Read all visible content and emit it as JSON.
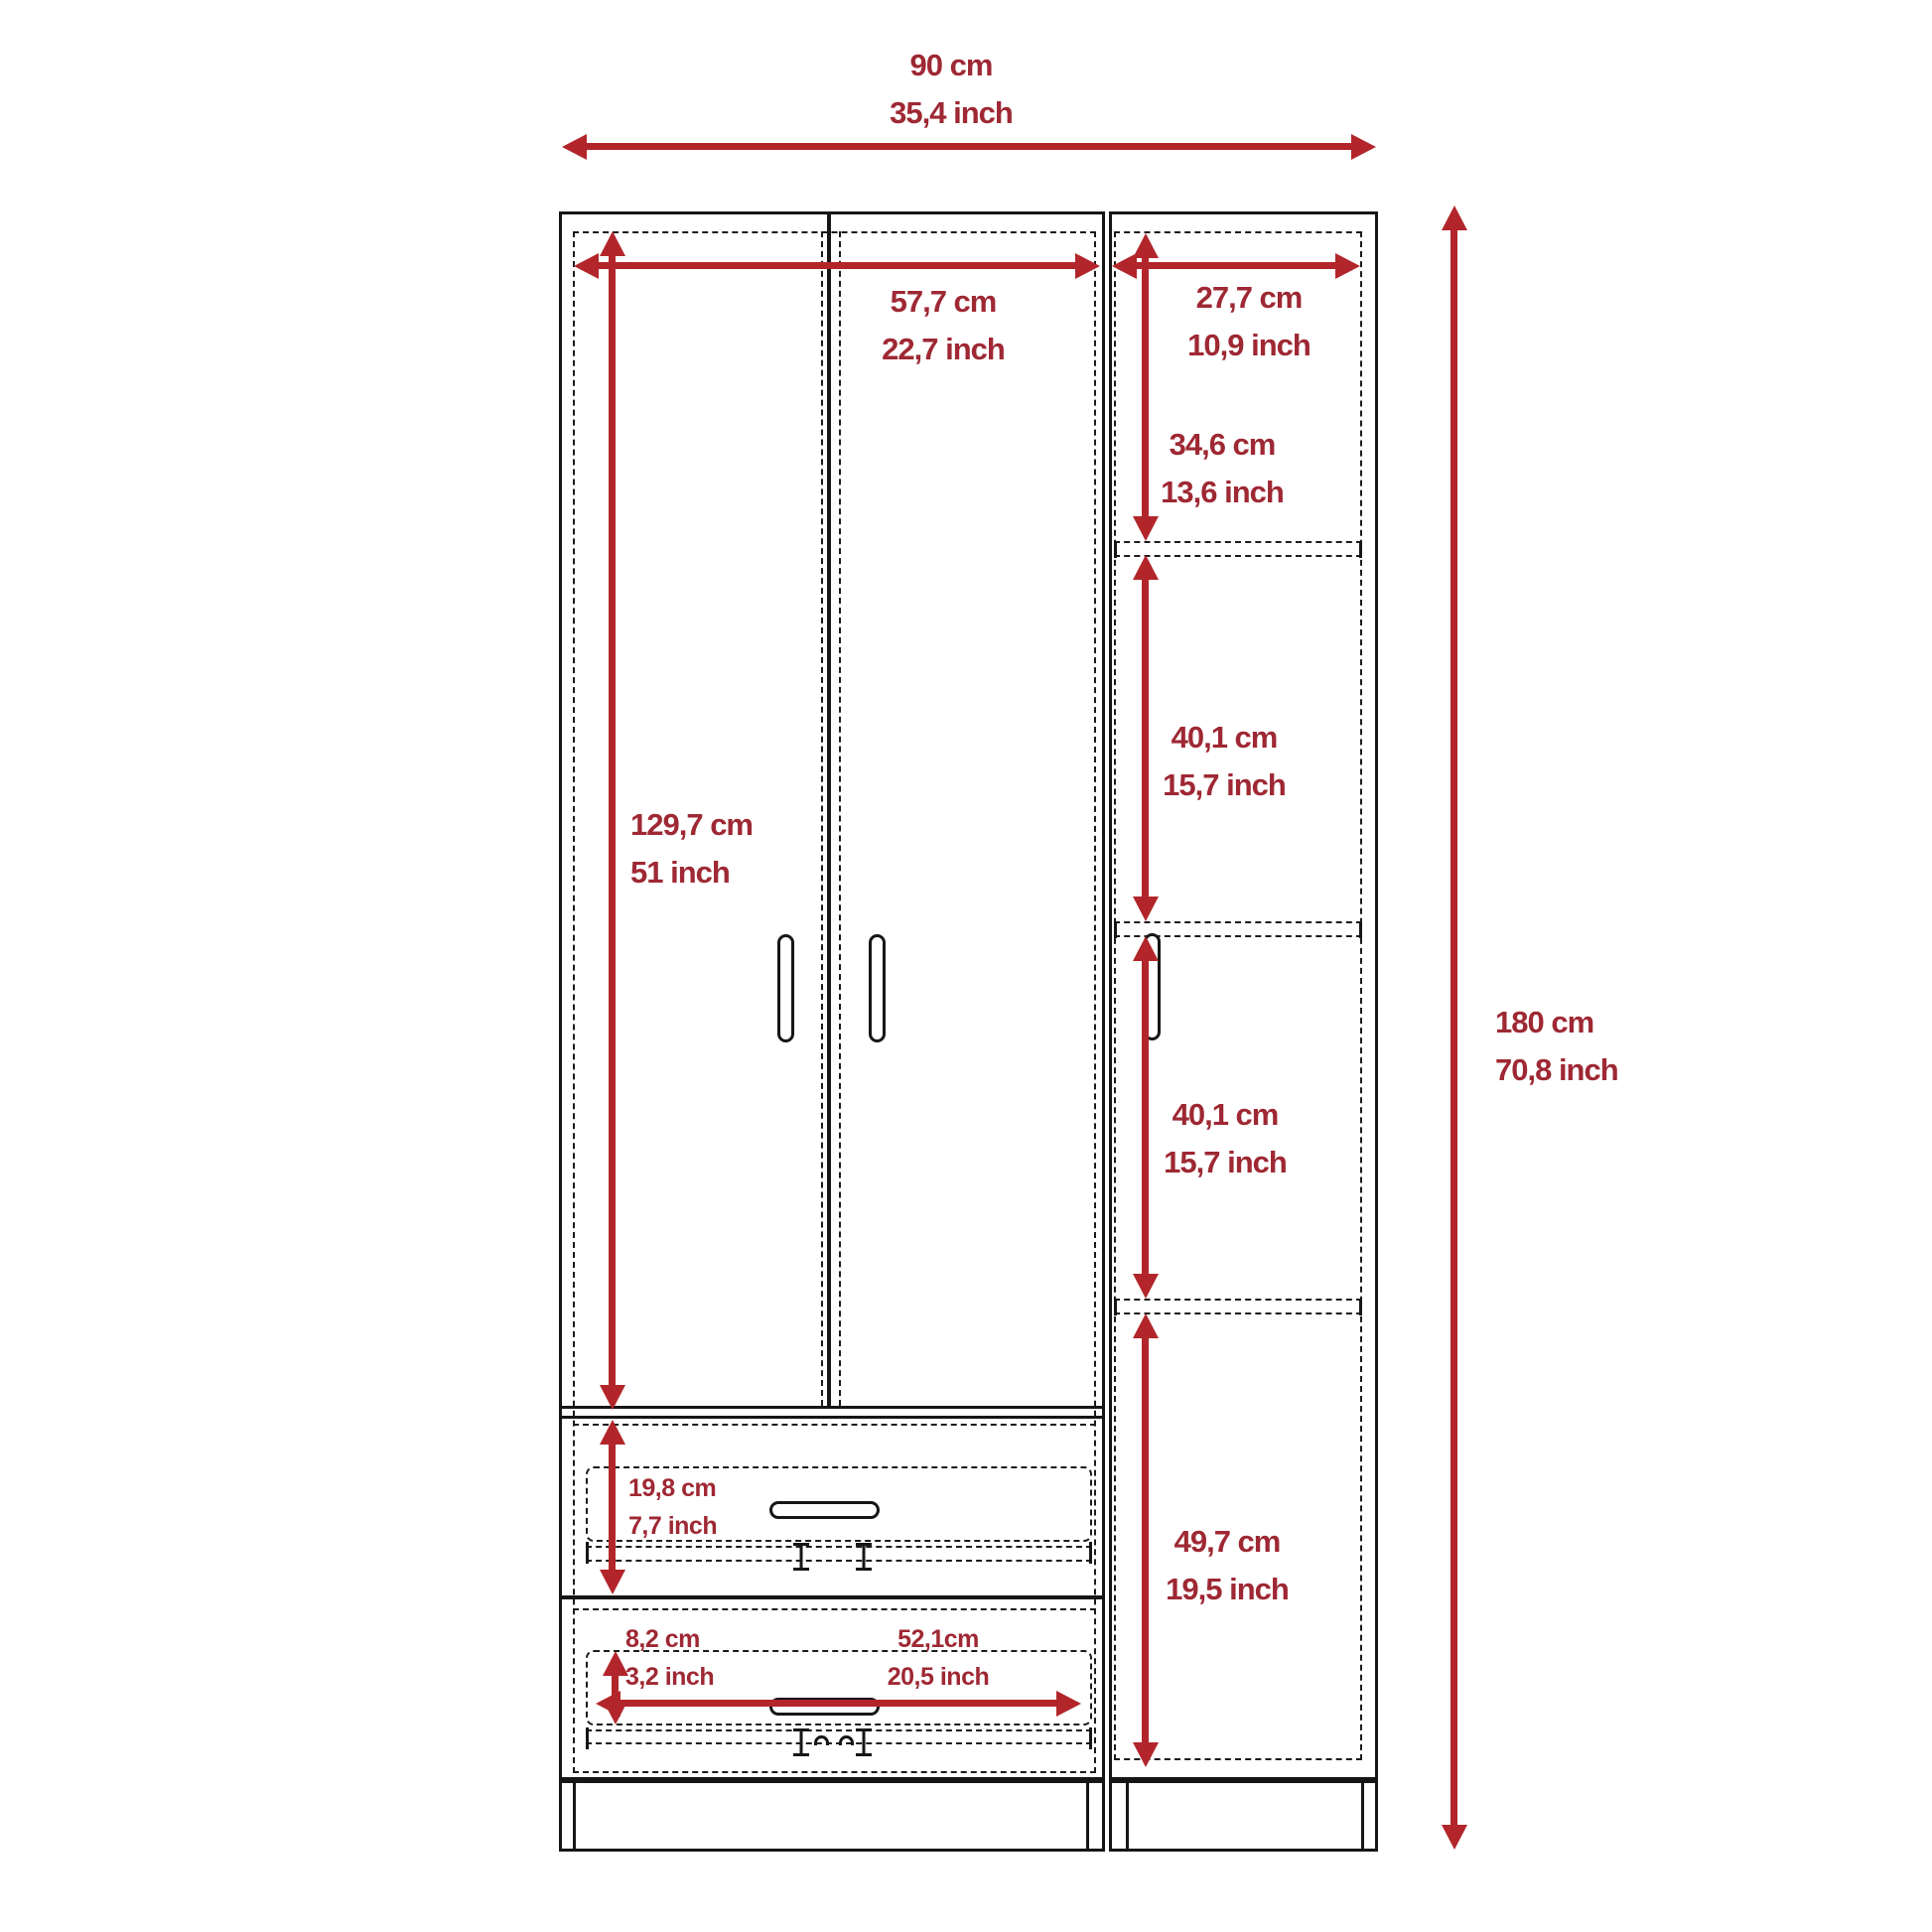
{
  "diagram": {
    "kind": "furniture dimension drawing",
    "colors": {
      "arrow": "#b2262b",
      "dimension_text": "#9e2833",
      "line": "#161616",
      "background": "#ffffff"
    },
    "dimensions": {
      "overall_width": {
        "cm": "90 cm",
        "inch": "35,4 inch"
      },
      "left_section_width": {
        "cm": "57,7 cm",
        "inch": "22,7 inch"
      },
      "right_section_width": {
        "cm": "27,7 cm",
        "inch": "10,9 inch"
      },
      "top_shelf": {
        "cm": "34,6 cm",
        "inch": "13,6 inch"
      },
      "upper_middle_shelf": {
        "cm": "40,1 cm",
        "inch": "15,7 inch"
      },
      "lower_middle_shelf": {
        "cm": "40,1 cm",
        "inch": "15,7 inch"
      },
      "bottom_shelf": {
        "cm": "49,7 cm",
        "inch": "19,5 inch"
      },
      "door_height": {
        "cm": "129,7 cm",
        "inch": "51 inch"
      },
      "overall_height": {
        "cm": "180 cm",
        "inch": "70,8 inch"
      },
      "top_drawer": {
        "cm": "19,8 cm",
        "inch": "7,7 inch"
      },
      "bottom_drawer": {
        "cm": "8,2 cm",
        "inch": "3,2 inch"
      },
      "drawer_width": {
        "cm": "52,1cm",
        "inch": "20,5 inch"
      }
    }
  }
}
